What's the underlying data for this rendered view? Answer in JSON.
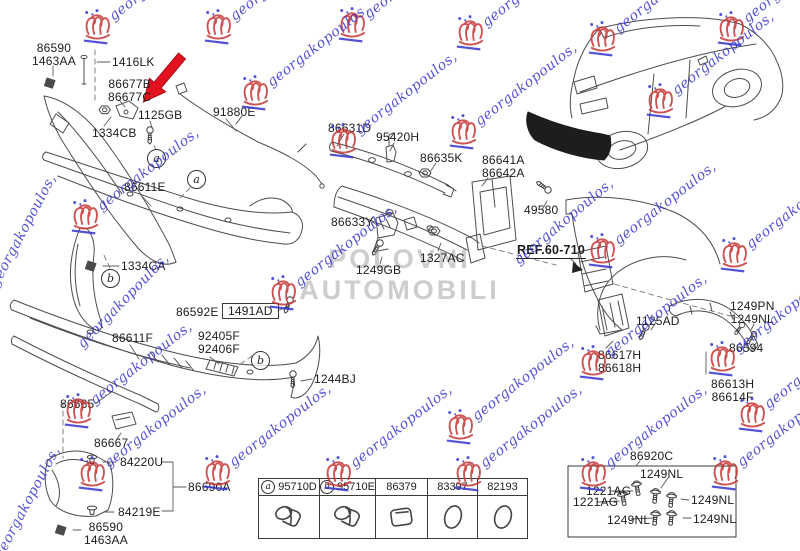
{
  "title": "Rear bumper parts diagram",
  "watermark": {
    "script_text": "georgakopoulos,",
    "center_lines": [
      "POLOVNI",
      "AUTOMOBILI"
    ],
    "stamp_color": "#c63434",
    "script_color": "#3535cf",
    "stamps": [
      [
        97,
        26
      ],
      [
        218,
        26
      ],
      [
        352,
        24
      ],
      [
        470,
        32
      ],
      [
        602,
        38
      ],
      [
        731,
        28
      ],
      [
        255,
        92
      ],
      [
        660,
        100
      ],
      [
        463,
        131
      ],
      [
        343,
        140
      ],
      [
        85,
        216
      ],
      [
        283,
        292
      ],
      [
        602,
        250
      ],
      [
        734,
        254
      ],
      [
        593,
        362
      ],
      [
        722,
        358
      ],
      [
        78,
        410
      ],
      [
        460,
        426
      ],
      [
        752,
        414
      ],
      [
        92,
        473
      ],
      [
        217,
        472
      ],
      [
        338,
        473
      ],
      [
        468,
        473
      ],
      [
        593,
        473
      ],
      [
        725,
        472
      ]
    ],
    "extra_scripts": [
      [
        -6,
        278,
        -62
      ],
      [
        -2,
        550,
        -62
      ],
      [
        80,
        338,
        -46
      ],
      [
        516,
        254,
        -40
      ]
    ]
  },
  "highlight": {
    "arrow_color": "#e31220"
  },
  "diagram": {
    "labels": [
      {
        "id": "86590-top",
        "lines": [
          "86590",
          "1463AA"
        ],
        "x": 32,
        "y": 42
      },
      {
        "id": "1416LK",
        "lines": [
          "1416LK"
        ],
        "x": 112,
        "y": 56
      },
      {
        "id": "86677",
        "lines": [
          "86677B",
          "86677C"
        ],
        "x": 108,
        "y": 78
      },
      {
        "id": "1125GB",
        "lines": [
          "1125GB"
        ],
        "x": 138,
        "y": 109
      },
      {
        "id": "1334CB",
        "lines": [
          "1334CB"
        ],
        "x": 92,
        "y": 127
      },
      {
        "id": "91880E",
        "lines": [
          "91880E"
        ],
        "x": 213,
        "y": 106
      },
      {
        "id": "86611E",
        "lines": [
          "86611E"
        ],
        "x": 124,
        "y": 181
      },
      {
        "id": "1334CA",
        "lines": [
          "1334CA"
        ],
        "x": 121,
        "y": 260
      },
      {
        "id": "86592E",
        "lines": [
          "86592E"
        ],
        "x": 176,
        "y": 306
      },
      {
        "id": "1491AD",
        "lines": [
          "1491AD"
        ],
        "x": 222,
        "y": 303,
        "boxed": true
      },
      {
        "id": "92405F",
        "lines": [
          "92405F",
          "92406F"
        ],
        "x": 198,
        "y": 330
      },
      {
        "id": "86611F",
        "lines": [
          "86611F"
        ],
        "x": 112,
        "y": 332
      },
      {
        "id": "1244BJ",
        "lines": [
          "1244BJ"
        ],
        "x": 314,
        "y": 373
      },
      {
        "id": "86665",
        "lines": [
          "86665"
        ],
        "x": 60,
        "y": 398
      },
      {
        "id": "86667",
        "lines": [
          "86667"
        ],
        "x": 94,
        "y": 437
      },
      {
        "id": "84220U",
        "lines": [
          "84220U"
        ],
        "x": 120,
        "y": 456
      },
      {
        "id": "86690A",
        "lines": [
          "86690A"
        ],
        "x": 188,
        "y": 481
      },
      {
        "id": "84219E",
        "lines": [
          "84219E"
        ],
        "x": 118,
        "y": 506
      },
      {
        "id": "86590-btm",
        "lines": [
          "86590",
          "1463AA"
        ],
        "x": 84,
        "y": 521
      },
      {
        "id": "86631D",
        "lines": [
          "86631D"
        ],
        "x": 328,
        "y": 122
      },
      {
        "id": "95420H",
        "lines": [
          "95420H"
        ],
        "x": 376,
        "y": 131
      },
      {
        "id": "86635K",
        "lines": [
          "86635K"
        ],
        "x": 420,
        "y": 152
      },
      {
        "id": "86641A",
        "lines": [
          "86641A",
          "86642A"
        ],
        "x": 482,
        "y": 154
      },
      {
        "id": "49580",
        "lines": [
          "49580"
        ],
        "x": 524,
        "y": 204
      },
      {
        "id": "86633Y",
        "lines": [
          "86633Y"
        ],
        "x": 331,
        "y": 216
      },
      {
        "id": "1327AC",
        "lines": [
          "1327AC"
        ],
        "x": 420,
        "y": 252
      },
      {
        "id": "1249GB",
        "lines": [
          "1249GB"
        ],
        "x": 356,
        "y": 264
      },
      {
        "id": "REF",
        "lines": [
          "REF.60-710"
        ],
        "x": 516,
        "y": 244,
        "underline": true
      },
      {
        "id": "1125AD",
        "lines": [
          "1125AD"
        ],
        "x": 636,
        "y": 315
      },
      {
        "id": "86617H",
        "lines": [
          "86617H",
          "86618H"
        ],
        "x": 598,
        "y": 349
      },
      {
        "id": "1249PN",
        "lines": [
          "1249PN",
          "1249NL"
        ],
        "x": 730,
        "y": 300
      },
      {
        "id": "86594",
        "lines": [
          "86594"
        ],
        "x": 729,
        "y": 342
      },
      {
        "id": "86613H",
        "lines": [
          "86613H",
          "86614F"
        ],
        "x": 711,
        "y": 378
      },
      {
        "id": "86920C",
        "lines": [
          "86920C"
        ],
        "x": 630,
        "y": 450
      },
      {
        "id": "nl-top",
        "lines": [
          "1249NL"
        ],
        "x": 640,
        "y": 468
      },
      {
        "id": "ag-1",
        "lines": [
          "1221AG"
        ],
        "x": 586,
        "y": 485
      },
      {
        "id": "ag-2",
        "lines": [
          "1221AG"
        ],
        "x": 573,
        "y": 496
      },
      {
        "id": "nl-right",
        "lines": [
          "1249NL"
        ],
        "x": 691,
        "y": 494
      },
      {
        "id": "nl-bl",
        "lines": [
          "1249NL"
        ],
        "x": 607,
        "y": 514
      },
      {
        "id": "nl-br",
        "lines": [
          "1249NL"
        ],
        "x": 693,
        "y": 513
      }
    ],
    "callouts": [
      {
        "letter": "a",
        "x": 156,
        "y": 158
      },
      {
        "letter": "a",
        "x": 196,
        "y": 179
      },
      {
        "letter": "b",
        "x": 110,
        "y": 278
      },
      {
        "letter": "b",
        "x": 260,
        "y": 360
      }
    ]
  },
  "parts_table": {
    "columns": [
      {
        "callout": "a",
        "part": "95710D",
        "icon": "sensor"
      },
      {
        "callout": "b",
        "part": "95710E",
        "icon": "sensor"
      },
      {
        "callout": "",
        "part": "86379",
        "icon": "plug-square"
      },
      {
        "callout": "",
        "part": "83397",
        "icon": "plug-oval"
      },
      {
        "callout": "",
        "part": "82193",
        "icon": "plug-oval"
      }
    ]
  },
  "hardware_box": {
    "kit_part": "86920C"
  }
}
